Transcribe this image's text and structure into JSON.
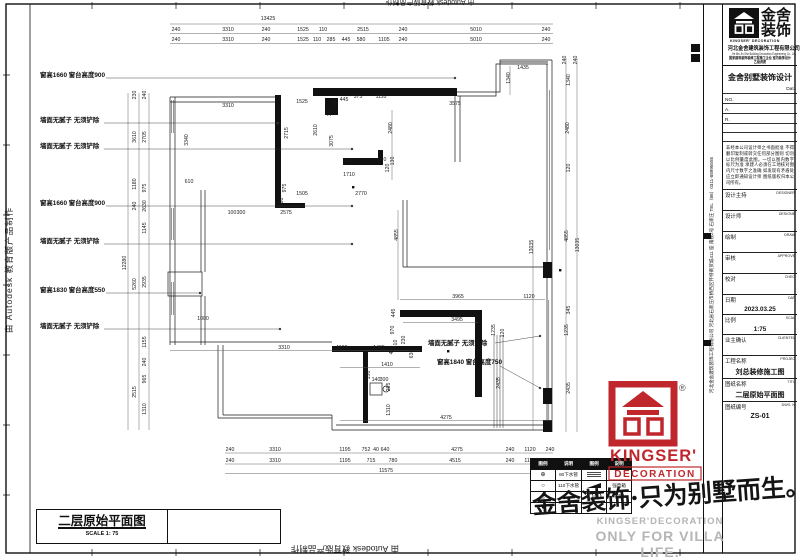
{
  "border": {
    "autodesk_left": "由 Autodesk 教育版产品制作",
    "autodesk_top": "由 Autodesk 教育版产品制作",
    "autodesk_bottom": "由 Autodesk 教育版产品制作"
  },
  "drawing_title_box": {
    "title": "二层原始平面图",
    "scale": "SCALE 1: 75"
  },
  "watermark": {
    "text": "金舍装饰·只为别墅而生。"
  },
  "gray_footer": {
    "line1": "KINGSER'DECORATION",
    "line2": "ONLY FOR VILLA LIFE."
  },
  "red_logo": {
    "name": "KINGSER'",
    "sub": "DECORATION",
    "reg": "®"
  },
  "legend": {
    "headers": [
      "图例",
      "说明",
      "图例",
      "说明"
    ],
    "rows": [
      [
        "⊕",
        "80下水管",
        "hatch",
        ""
      ],
      [
        "○",
        "110下水管",
        "wedge",
        "强电箱"
      ],
      [
        "◎",
        "",
        "circ",
        "冷热水"
      ],
      [
        "●",
        "",
        "",
        ""
      ]
    ]
  },
  "titleblock": {
    "logo_name_line1": "金舍",
    "logo_name_line2": "装饰",
    "logo_sub": "KINGSER'  DECORATION",
    "company_cn": "河北金舍建筑装饰工程有限公司",
    "company_en": "He Bei Jin She Building Decoration Engineering Co., Ltd.",
    "cert_line": "国家建筑装饰装修工程施工企业 室内装饰设计乙级资质",
    "project_title": "金舍别墅装饰设计",
    "dat_label": "Dat.",
    "no_labels": [
      "NO.",
      "A.",
      "R."
    ],
    "disclaimer": "非经本公司设计师之书面批准 不得翻印复制或转交任何部分图则 切勿以比例量度此图。一切以图内数字标尺为准 承建人必须在工地核对图内尺寸数字之准确 如发现有矛盾处 应立即通知设计师 图纸版权归本公司所有。",
    "rows": [
      {
        "cn": "设计主持",
        "en": "DESIGNER",
        "val": ""
      },
      {
        "cn": "设计师",
        "en": "DESIGNE",
        "val": ""
      },
      {
        "cn": "绘制",
        "en": "DRAW",
        "val": ""
      },
      {
        "cn": "审核",
        "en": "APPROVE",
        "val": ""
      },
      {
        "cn": "校对",
        "en": "CHEC",
        "val": ""
      },
      {
        "cn": "日期",
        "en": "DAT",
        "val": "2023.03.25"
      },
      {
        "cn": "比例",
        "en": "SCAL",
        "val": "1:75"
      },
      {
        "cn": "业主确认",
        "en": "CLIENTEL",
        "val": ""
      },
      {
        "cn": "工程名称",
        "en": "PROJEC",
        "val": "刘总装修施工图",
        "big": true
      },
      {
        "cn": "图纸名称",
        "en": "TITL",
        "val": "二层原始平面图",
        "big": true
      },
      {
        "cn": "图纸编号",
        "en": "DWG. N",
        "val": "ZS-01",
        "big": true
      }
    ],
    "vertical_address": "河北金舍建筑装饰工程有限公司  河北省石家庄市桥西区怀特商贸城411 座 南楼2号 石家庄 TEL（86）0311-88995555"
  },
  "plan": {
    "labels": [
      {
        "t": "窗高1660  窗台高度900",
        "x": 40,
        "y": 77
      },
      {
        "t": "墙面无腻子 无须铲除",
        "x": 40,
        "y": 122
      },
      {
        "t": "墙面无腻子 无须铲除",
        "x": 40,
        "y": 148
      },
      {
        "t": "窗高1660  窗台高度900",
        "x": 40,
        "y": 205
      },
      {
        "t": "墙面无腻子 无须铲除",
        "x": 40,
        "y": 243
      },
      {
        "t": "窗高1830  窗台高度550",
        "x": 40,
        "y": 292
      },
      {
        "t": "墙面无腻子 无须铲除",
        "x": 40,
        "y": 328
      },
      {
        "t": "墙面无腻子 无须铲除",
        "x": 428,
        "y": 345
      },
      {
        "t": "窗高1840  窗台高度750",
        "x": 437,
        "y": 364
      }
    ],
    "leaders": [
      [
        106,
        78,
        455,
        78
      ],
      [
        104,
        123,
        278,
        123
      ],
      [
        104,
        149,
        352,
        149
      ],
      [
        106,
        206,
        352,
        206
      ],
      [
        104,
        244,
        352,
        244
      ],
      [
        106,
        293,
        200,
        293
      ],
      [
        104,
        329,
        280,
        329
      ],
      [
        495,
        343,
        540,
        336
      ],
      [
        500,
        366,
        540,
        388
      ]
    ],
    "dims_h": [
      {
        "t": "13425",
        "x": 268,
        "y": 20
      },
      {
        "t": "240",
        "x": 176,
        "y": 31
      },
      {
        "t": "3310",
        "x": 228,
        "y": 31
      },
      {
        "t": "240",
        "x": 266,
        "y": 31
      },
      {
        "t": "1525",
        "x": 303,
        "y": 31
      },
      {
        "t": "110",
        "x": 323,
        "y": 31
      },
      {
        "t": "2515",
        "x": 363,
        "y": 31
      },
      {
        "t": "240",
        "x": 403,
        "y": 31
      },
      {
        "t": "5010",
        "x": 476,
        "y": 31
      },
      {
        "t": "240",
        "x": 546,
        "y": 31
      },
      {
        "t": "240",
        "x": 176,
        "y": 41
      },
      {
        "t": "3310",
        "x": 228,
        "y": 41
      },
      {
        "t": "240",
        "x": 266,
        "y": 41
      },
      {
        "t": "1525",
        "x": 303,
        "y": 41
      },
      {
        "t": "110",
        "x": 317,
        "y": 41
      },
      {
        "t": "285",
        "x": 331,
        "y": 41
      },
      {
        "t": "445",
        "x": 346,
        "y": 41
      },
      {
        "t": "580",
        "x": 361,
        "y": 41
      },
      {
        "t": "1105",
        "x": 384,
        "y": 41
      },
      {
        "t": "240",
        "x": 403,
        "y": 41
      },
      {
        "t": "5010",
        "x": 476,
        "y": 41
      },
      {
        "t": "240",
        "x": 546,
        "y": 41
      },
      {
        "t": "3310",
        "x": 228,
        "y": 107
      },
      {
        "t": "1525",
        "x": 302,
        "y": 103
      },
      {
        "t": "445",
        "x": 344,
        "y": 101
      },
      {
        "t": "575",
        "x": 358,
        "y": 98
      },
      {
        "t": "1110",
        "x": 381,
        "y": 98
      },
      {
        "t": "3575",
        "x": 455,
        "y": 105
      },
      {
        "t": "1435",
        "x": 523,
        "y": 69
      },
      {
        "t": "1600",
        "x": 349,
        "y": 162
      },
      {
        "t": "810",
        "x": 382,
        "y": 161
      },
      {
        "t": "1710",
        "x": 349,
        "y": 176
      },
      {
        "t": "1505",
        "x": 302,
        "y": 195
      },
      {
        "t": "2770",
        "x": 361,
        "y": 195
      },
      {
        "t": "610",
        "x": 189,
        "y": 183
      },
      {
        "t": "2575",
        "x": 286,
        "y": 214
      },
      {
        "t": "100",
        "x": 232,
        "y": 214
      },
      {
        "t": "300",
        "x": 241,
        "y": 214
      },
      {
        "t": "1000",
        "x": 203,
        "y": 320
      },
      {
        "t": "3965",
        "x": 458,
        "y": 298
      },
      {
        "t": "1120",
        "x": 529,
        "y": 298
      },
      {
        "t": "3495",
        "x": 457,
        "y": 321
      },
      {
        "t": "3310",
        "x": 284,
        "y": 349
      },
      {
        "t": "1195",
        "x": 342,
        "y": 349
      },
      {
        "t": "1495",
        "x": 379,
        "y": 349
      },
      {
        "t": "1410",
        "x": 387,
        "y": 366
      },
      {
        "t": "140",
        "x": 376,
        "y": 381
      },
      {
        "t": "300",
        "x": 384,
        "y": 381
      },
      {
        "t": "4275",
        "x": 446,
        "y": 419
      },
      {
        "t": "240",
        "x": 230,
        "y": 451
      },
      {
        "t": "3310",
        "x": 275,
        "y": 451
      },
      {
        "t": "1195",
        "x": 345,
        "y": 451
      },
      {
        "t": "752",
        "x": 366,
        "y": 451
      },
      {
        "t": "40",
        "x": 376,
        "y": 451
      },
      {
        "t": "640",
        "x": 385,
        "y": 451
      },
      {
        "t": "4275",
        "x": 457,
        "y": 451
      },
      {
        "t": "240",
        "x": 510,
        "y": 451
      },
      {
        "t": "1120",
        "x": 530,
        "y": 451
      },
      {
        "t": "240",
        "x": 550,
        "y": 451
      },
      {
        "t": "240",
        "x": 230,
        "y": 462
      },
      {
        "t": "3310",
        "x": 275,
        "y": 462
      },
      {
        "t": "1195",
        "x": 345,
        "y": 462
      },
      {
        "t": "715",
        "x": 371,
        "y": 462
      },
      {
        "t": "780",
        "x": 393,
        "y": 462
      },
      {
        "t": "4515",
        "x": 455,
        "y": 462
      },
      {
        "t": "240",
        "x": 510,
        "y": 462
      },
      {
        "t": "1120",
        "x": 530,
        "y": 462
      },
      {
        "t": "240",
        "x": 550,
        "y": 462
      },
      {
        "t": "11575",
        "x": 386,
        "y": 472
      }
    ],
    "dims_v": [
      {
        "t": "230",
        "x": 136,
        "y": 95
      },
      {
        "t": "240",
        "x": 146,
        "y": 95
      },
      {
        "t": "3610",
        "x": 136,
        "y": 137
      },
      {
        "t": "2705",
        "x": 146,
        "y": 137
      },
      {
        "t": "1180",
        "x": 136,
        "y": 184
      },
      {
        "t": "975",
        "x": 146,
        "y": 188
      },
      {
        "t": "240",
        "x": 136,
        "y": 206
      },
      {
        "t": "2630",
        "x": 146,
        "y": 206
      },
      {
        "t": "1145",
        "x": 146,
        "y": 228
      },
      {
        "t": "12280",
        "x": 126,
        "y": 263
      },
      {
        "t": "5260",
        "x": 136,
        "y": 284
      },
      {
        "t": "2935",
        "x": 146,
        "y": 282
      },
      {
        "t": "1155",
        "x": 146,
        "y": 342
      },
      {
        "t": "240",
        "x": 146,
        "y": 362
      },
      {
        "t": "965",
        "x": 146,
        "y": 379
      },
      {
        "t": "2515",
        "x": 136,
        "y": 392
      },
      {
        "t": "1310",
        "x": 146,
        "y": 409
      },
      {
        "t": "3340",
        "x": 188,
        "y": 140
      },
      {
        "t": "405",
        "x": 336,
        "y": 103
      },
      {
        "t": "365",
        "x": 331,
        "y": 112
      },
      {
        "t": "2715",
        "x": 288,
        "y": 133
      },
      {
        "t": "2610",
        "x": 317,
        "y": 130
      },
      {
        "t": "3075",
        "x": 333,
        "y": 141
      },
      {
        "t": "975",
        "x": 286,
        "y": 188
      },
      {
        "t": "180",
        "x": 283,
        "y": 202
      },
      {
        "t": "2480",
        "x": 392,
        "y": 128
      },
      {
        "t": "130",
        "x": 394,
        "y": 161
      },
      {
        "t": "120",
        "x": 389,
        "y": 168
      },
      {
        "t": "1340",
        "x": 510,
        "y": 78
      },
      {
        "t": "240",
        "x": 566,
        "y": 60
      },
      {
        "t": "240",
        "x": 577,
        "y": 60
      },
      {
        "t": "1340",
        "x": 570,
        "y": 80
      },
      {
        "t": "2480",
        "x": 569,
        "y": 128
      },
      {
        "t": "120",
        "x": 570,
        "y": 168
      },
      {
        "t": "4855",
        "x": 568,
        "y": 236
      },
      {
        "t": "13035",
        "x": 579,
        "y": 245
      },
      {
        "t": "345",
        "x": 570,
        "y": 310
      },
      {
        "t": "1235",
        "x": 568,
        "y": 330
      },
      {
        "t": "2435",
        "x": 570,
        "y": 388
      },
      {
        "t": "4855",
        "x": 398,
        "y": 235
      },
      {
        "t": "13035",
        "x": 533,
        "y": 247
      },
      {
        "t": "445",
        "x": 395,
        "y": 313
      },
      {
        "t": "410",
        "x": 397,
        "y": 344
      },
      {
        "t": "970",
        "x": 394,
        "y": 330
      },
      {
        "t": "230",
        "x": 405,
        "y": 340
      },
      {
        "t": "400",
        "x": 393,
        "y": 350
      },
      {
        "t": "630",
        "x": 413,
        "y": 354
      },
      {
        "t": "1235",
        "x": 495,
        "y": 330
      },
      {
        "t": "150",
        "x": 370,
        "y": 375
      },
      {
        "t": "265",
        "x": 390,
        "y": 387
      },
      {
        "t": "1310",
        "x": 390,
        "y": 410
      },
      {
        "t": "2435",
        "x": 500,
        "y": 383
      },
      {
        "t": "120",
        "x": 504,
        "y": 333
      }
    ]
  }
}
